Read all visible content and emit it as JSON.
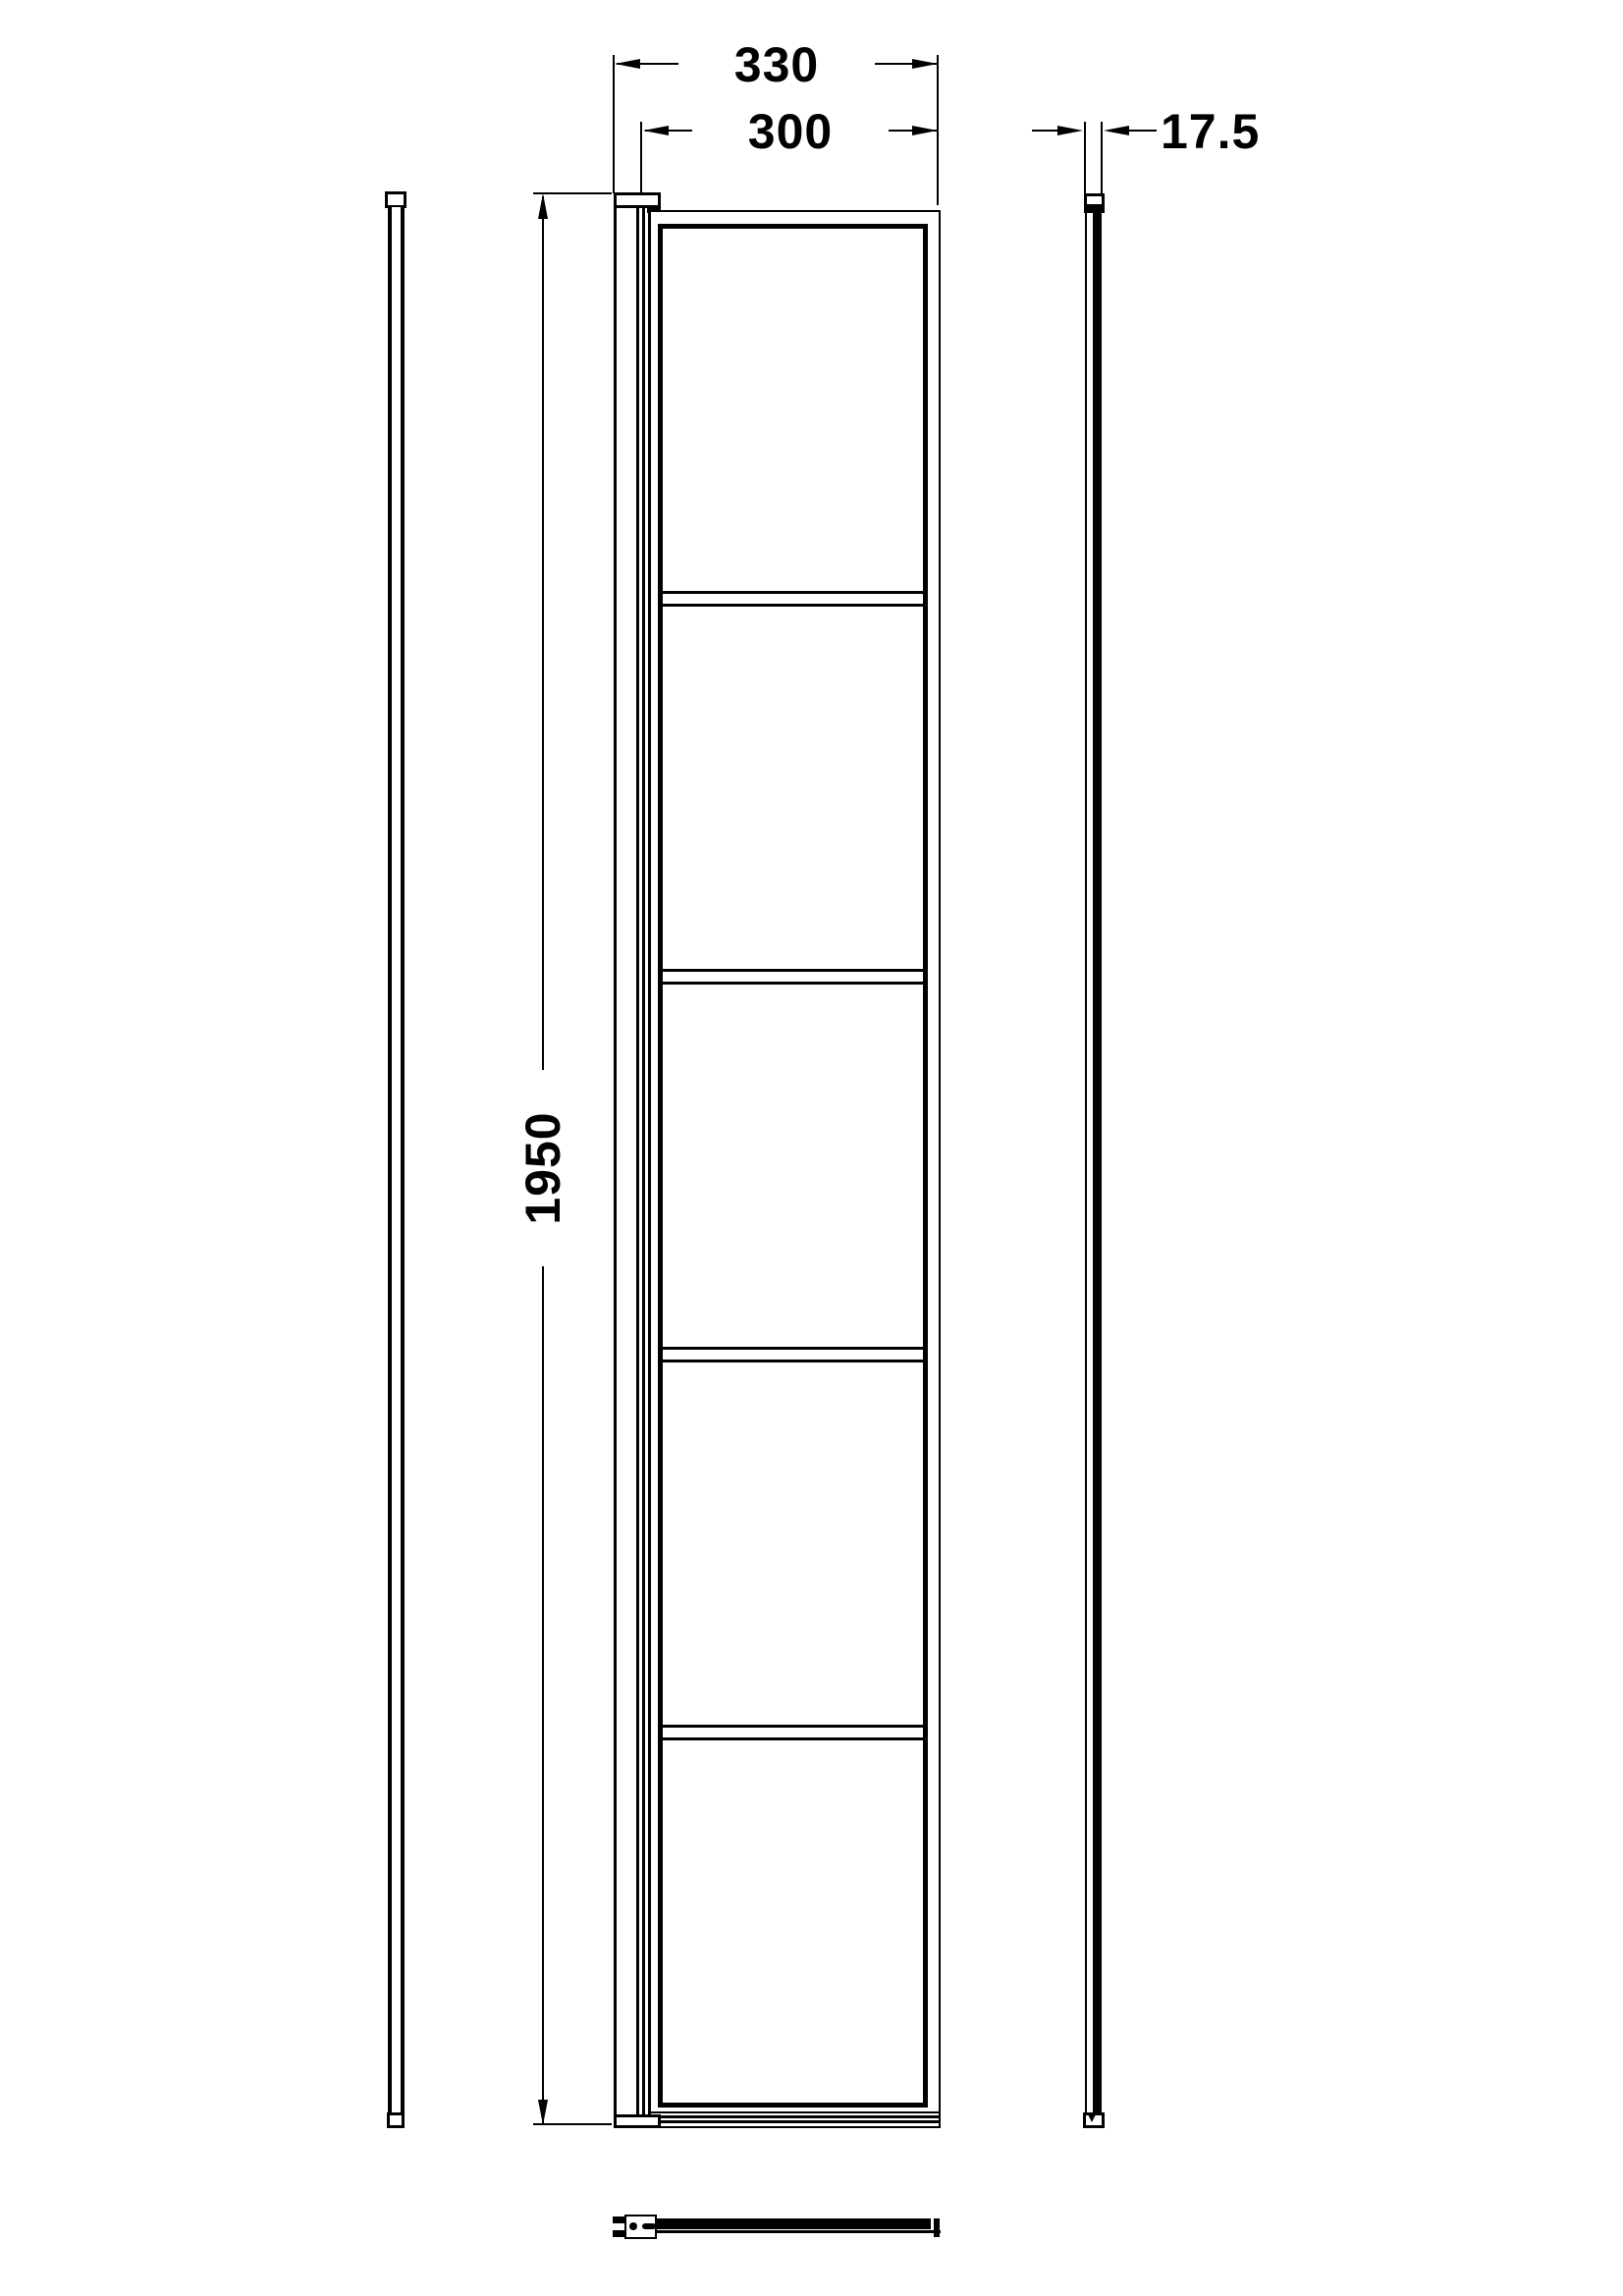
{
  "drawing": {
    "background_color": "#ffffff",
    "line_color": "#000000",
    "dims": {
      "overall_width": "330",
      "glass_width": "300",
      "height": "1950",
      "profile_thickness": "17.5"
    },
    "front_view": {
      "panel_count": 5
    }
  }
}
